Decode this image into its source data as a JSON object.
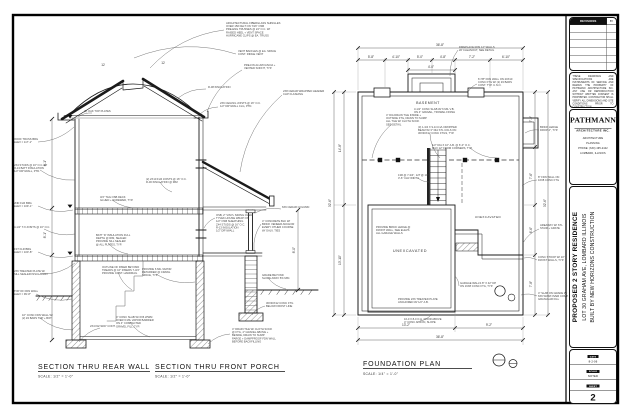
{
  "sheet": {
    "background": "#ffffff",
    "line_color": "#1b1b1b",
    "note_color": "#474747"
  },
  "drawings": [
    {
      "id": "rear-wall",
      "label": "SECTION THRU REAR WALL",
      "scale": "SCALE: 1/2\" = 1'-0\""
    },
    {
      "id": "front-porch",
      "label": "SECTION THRU FRONT PORCH",
      "scale": "SCALE: 1/2\" = 1'-0\""
    },
    {
      "id": "foundation",
      "label": "FOUNDATION PLAN",
      "scale": "SCALE: 1/4\" = 1'-0\""
    }
  ],
  "plan_labels": {
    "basement": "BASEMENT",
    "unexcavated_1": "UNEXCAVATED",
    "unexcavated_2": "UNEXCAVATED"
  },
  "titleblock": {
    "revisions": {
      "header": "REVISIONS",
      "by": "BY"
    },
    "disclaimer": "THESE DRAWINGS AND SPECIFICATIONS ARE INSTRUMENTS OF SERVICE AND REMAIN THE PROPERTY OF PATHMANN ARCHITECTURE INC. ANY USE OR REPRODUCTION WITHOUT WRITTEN CONSENT IS PROHIBITED. CONTRACTOR SHALL VERIFY ALL DIMENSIONS AND SITE CONDITIONS PRIOR TO CONSTRUCTION.",
    "firm": {
      "name": "PATHMANN",
      "sub": "ARCHITECTURE INC.",
      "lines": [
        "ARCHITECTURE",
        "PLANNING",
        "PHONE: (630) 495-2442",
        "LOMBARD, ILLINOIS"
      ]
    },
    "project": {
      "lines": [
        "PROPOSED 2 STORY RESIDENCE",
        "LOT 30 GRAHAM AVE, LOMBARD ILLINOIS",
        "BUILT BY NEW HORIZONS CONSTRUCTION"
      ]
    },
    "sheetinfo": {
      "rows": [
        {
          "label": "DATE",
          "value": "8-2-06"
        },
        {
          "label": "SCALE",
          "value": "NOTED"
        },
        {
          "label": "DRAWN",
          "value": "RP"
        }
      ],
      "sheet_label": "SHEET",
      "number": "2",
      "of_label": "OF",
      "of_value": "FIVE"
    }
  },
  "callouts": [
    {
      "x": 226,
      "y": 24,
      "s": [
        224,
        30
      ],
      "t": [
        150,
        68
      ],
      "l": [
        "ARCHITECTURAL FIBERGLASS SHINGLES",
        "OVER 15# FELT ON 7/16\" OSB",
        "PRE-ENG TRUSSES @ 24\" O.C. W/",
        "RAISED HEEL + VENT SPACE",
        "HURRICANE CLIPS @ EA. TRUSS"
      ]
    },
    {
      "x": 238,
      "y": 52,
      "s": [
        236,
        54
      ],
      "t": [
        134,
        58
      ],
      "l": [
        "VENT BAFFLES @ EA. SPACE",
        "CONT. RIDGE VENT"
      ]
    },
    {
      "x": 244,
      "y": 66,
      "s": [
        242,
        70
      ],
      "t": [
        207,
        112
      ],
      "l": [
        "PRE-FIN ALUM FASCIA +",
        "VENTED SOFFIT, TYP."
      ]
    },
    {
      "x": 208,
      "y": 88,
      "s": [
        206,
        89
      ],
      "t": [
        178,
        98
      ],
      "l": [
        "R-38 INSULATION"
      ]
    },
    {
      "x": 220,
      "y": 104,
      "s": [
        218,
        107
      ],
      "t": [
        200,
        114
      ],
      "l": [
        "2X6 CEILING JOISTS @ 16\" O.C.",
        "1/2\" DRYWALL CLG, PTD."
      ]
    },
    {
      "x": 84,
      "y": 112,
      "t": [
        78,
        117
      ],
      "s": [
        92,
        113
      ],
      "l": [
        "(2) OAK TOP PLATES"
      ]
    },
    {
      "x": 14,
      "y": 140,
      "s": [
        38,
        142
      ],
      "t": [
        74,
        127
      ],
      "l": [
        "ROOF TRUSS BRG",
        "ELEV = 117'-1\""
      ]
    },
    {
      "x": 14,
      "y": 166,
      "s": [
        40,
        170
      ],
      "t": [
        75,
        180
      ],
      "l": [
        "2X4 STUDS @ 16\" O.C. W/",
        "R-13 BATT INSULATION",
        "1/2\" DRYWALL, PTD."
      ]
    },
    {
      "x": 100,
      "y": 198,
      "s": [
        112,
        200
      ],
      "t": [
        140,
        208
      ],
      "l": [
        "3/4\" T&G OSB DECK",
        "GLUED + SCREWED, TYP."
      ]
    },
    {
      "x": 14,
      "y": 204,
      "s": [
        38,
        206
      ],
      "t": [
        73,
        210
      ],
      "l": [
        "2ND FLR BRG",
        "ELEV = 109'-1\""
      ]
    },
    {
      "x": 14,
      "y": 228,
      "s": [
        44,
        229
      ],
      "t": [
        75,
        234
      ],
      "l": [
        "9-1/2\" TJI JOISTS @ 16\" O.C."
      ]
    },
    {
      "x": 14,
      "y": 250,
      "s": [
        38,
        252
      ],
      "t": [
        73,
        256
      ],
      "l": [
        "1ST FLR BRG",
        "ELEV = 100'-8\""
      ]
    },
    {
      "x": 96,
      "y": 236,
      "s": [
        108,
        243
      ],
      "t": [
        128,
        254
      ],
      "l": [
        "BATT 'R' INSULATION FULL",
        "DEPTH @ RIM, SEALED",
        "PROVIDE SILL SEALER",
        "@ ALL PLATES, TYP."
      ]
    },
    {
      "x": 14,
      "y": 272,
      "s": [
        42,
        274
      ],
      "t": [
        75,
        263
      ],
      "l": [
        "2X6 TREATED PLATE W/",
        "SILL SEALER INSULATION"
      ]
    },
    {
      "x": 14,
      "y": 292,
      "s": [
        36,
        294
      ],
      "t": [
        72,
        299
      ],
      "l": [
        "TOP OF FDN WALL",
        "ELEV = 99'-8\""
      ]
    },
    {
      "x": 22,
      "y": 316,
      "s": [
        40,
        318
      ],
      "t": [
        73,
        330
      ],
      "l": [
        "10\" CONC FDN WALL W/",
        "(2) #4 BARS TOP + BOT"
      ]
    },
    {
      "x": 90,
      "y": 327,
      "s": [
        100,
        328
      ],
      "t": [
        79,
        342
      ],
      "l": [
        "2X4 KEYWAY CONT."
      ]
    },
    {
      "x": 116,
      "y": 318,
      "s": [
        130,
        322
      ],
      "t": [
        150,
        337
      ],
      "l": [
        "4\" CONC SLAB W/ 6X6 WWM",
        "OVER 6 MIL VAPOR BARRIER",
        "ON 4\" COMPACTED",
        "GRAVEL FILL, TYP."
      ]
    },
    {
      "x": 102,
      "y": 268,
      "s": [
        118,
        272
      ],
      "t": [
        132,
        290
      ],
      "l": [
        "OUTLINE OF RISER BEYOND",
        "TREADS @ 10\" RISERS 7-3/4\"",
        "PROVIDE CONT. HANDRAIL"
      ]
    },
    {
      "x": 216,
      "y": 216,
      "s": [
        215,
        218
      ],
      "t": [
        204,
        228
      ],
      "l": [
        "OSB, 2\" VINYL SIDING OVER",
        "TYVEK HOUSE WRAP ON",
        "1/2\" OSB SHEATHING",
        "2X4 STUDS @ 16\" O.C.",
        "R-13 INSULATION",
        "1/2\" DRYWALL"
      ]
    },
    {
      "x": 262,
      "y": 222,
      "s": [
        261,
        224
      ],
      "t": [
        254,
        250
      ],
      "l": [
        "4\" CONCRETE BLK W/",
        "BRICK VENEER ANCHOR",
        "EVERY OTHER COURSE",
        "W/ GALV. TIES"
      ]
    },
    {
      "x": 146,
      "y": 180,
      "s": [
        160,
        182
      ],
      "t": [
        172,
        192
      ],
      "l": [
        "(2) 2X10 FLR JOISTS @ 16\" O.C.",
        "R-30 INSULATION @ RIM"
      ]
    },
    {
      "x": 282,
      "y": 208,
      "s": [
        281,
        209
      ],
      "t": [
        255,
        213
      ],
      "l": [
        "6X6 CEDAR COLUMN"
      ]
    },
    {
      "x": 283,
      "y": 92,
      "s": [
        282,
        95
      ],
      "t": [
        240,
        172
      ],
      "l": [
        "2X8 CEDAR WRAPPED HEADER",
        "CLIP FLASHING"
      ]
    },
    {
      "x": 142,
      "y": 270,
      "s": [
        156,
        274
      ],
      "t": [
        195,
        282
      ],
      "l": [
        "PROVIDE 6 MIL VAPOR",
        "RETARDER @ CRAWL",
        "SPACE, TYP."
      ]
    },
    {
      "x": 262,
      "y": 276,
      "s": [
        268,
        278
      ],
      "t": [
        286,
        289
      ],
      "l": [
        "GRADE BEYOND",
        "SLOPE AWAY 5% MIN."
      ]
    },
    {
      "x": 232,
      "y": 330,
      "s": [
        230,
        334
      ],
      "t": [
        208,
        344
      ],
      "l": [
        "4\" DRAIN TILE W/ CLOTH SOCK",
        "@ FTG, 4\" GRAVEL ABOVE +",
        "BESIDE, DRAIN TO SUMP",
        "PARGE + DAMPPROOF FDN WALL",
        "BEFORE BACKFILLING"
      ]
    },
    {
      "x": 266,
      "y": 304,
      "s": [
        265,
        306
      ],
      "t": [
        252,
        315
      ],
      "l": [
        "30X30X12 CONC FTG",
        "BELOW FROST LINE"
      ]
    },
    {
      "x": 478,
      "y": 80,
      "s": [
        477,
        84
      ],
      "t": [
        468,
        92
      ],
      "l": [
        "8 7/8\" FDN WALL ON 20X10",
        "CONC FTG W/ (2) #4 BARS",
        "CONT. TYP. U.N.O."
      ]
    },
    {
      "x": 459,
      "y": 48,
      "s": [
        458,
        50
      ],
      "t": [
        450,
        76
      ],
      "l": [
        "FIREPLACE FDN 12\" WALLS",
        "W/ CLEANOUT, SEE DETAIL"
      ]
    },
    {
      "x": 386,
      "y": 116,
      "s": [
        392,
        124
      ],
      "t": [
        372,
        158
      ],
      "l": [
        "4\" DIA DRAIN TILE INSIDE +",
        "OUTSIDE FTG, DRAIN TO SUMP",
        "ALL TILE W/ CLOTH SOCK",
        "SEE DETAIL"
      ]
    },
    {
      "x": 418,
      "y": 128,
      "s": [
        430,
        134
      ],
      "t": [
        440,
        158
      ],
      "l": [
        "(3) 1-3/4 X 9-1/4 LVL DROPPED",
        "BEAM W/ 3\" DIA STL COLS ON",
        "30X30X12 CONC FTGS, TYP."
      ]
    },
    {
      "x": 432,
      "y": 146,
      "s": [
        470,
        148
      ],
      "t": [
        497,
        158
      ],
      "l": [
        "1/2\" DIA X 10\" A.B. @ 6'-0\" O.C.",
        "MAX 12\" FROM CORNERS, TYP."
      ]
    },
    {
      "x": 540,
      "y": 128,
      "s": [
        539,
        130
      ],
      "t": [
        525,
        133
      ],
      "l": [
        "BRICK LEDGE",
        "DROP 4\", TYP."
      ]
    },
    {
      "x": 538,
      "y": 178,
      "s": [
        537,
        180
      ],
      "t": [
        522,
        186
      ],
      "l": [
        "8\" FDN WALL ON",
        "16X8 CONC FTG"
      ]
    },
    {
      "x": 540,
      "y": 226,
      "s": [
        539,
        229
      ],
      "t": [
        523,
        243
      ],
      "l": [
        "AREAWAY W/ STL",
        "STAIR + GRATE"
      ]
    },
    {
      "x": 538,
      "y": 258,
      "s": [
        537,
        260
      ],
      "t": [
        524,
        258
      ],
      "l": [
        "CONC STOOP W/ 10\"",
        "FROST WALLS, TYP."
      ]
    },
    {
      "x": 538,
      "y": 294,
      "s": [
        537,
        296
      ],
      "t": [
        521,
        295
      ],
      "l": [
        "4\" SLAB ON GRADE W/",
        "6X6 WWM OVER COMP.",
        "GRANULAR FILL"
      ]
    },
    {
      "x": 398,
      "y": 300,
      "l": [
        "PROVIDE 2X6 TREATED PLATE",
        "ANCHORED W/ 1/2\" A.B."
      ]
    },
    {
      "x": 460,
      "y": 284,
      "s": [
        459,
        286
      ],
      "t": [
        455,
        276
      ],
      "l": [
        "GARAGE WALLS 8\" X 42\" DP",
        "ON 16X8 CONC FTG, TYP."
      ]
    },
    {
      "x": 414,
      "y": 110,
      "l": [
        "3-1/2\" CONC SLAB W/ 6 MIL V.B.",
        "ON 4\" GRAVEL, TROWEL FINISH"
      ]
    },
    {
      "x": 398,
      "y": 176,
      "s": [
        418,
        178
      ],
      "t": [
        429,
        182
      ],
      "l": [
        "13R @ 7-3/4\", 12T @ 10\"",
        "3'-6\" CLR WIDTH"
      ]
    },
    {
      "x": 376,
      "y": 228,
      "l": [
        "PROVIDE BRICK LEDGE @",
        "FRONT WALL, SEE ELEVS",
        "ALL GARAGE WALLS"
      ]
    },
    {
      "x": 404,
      "y": 320,
      "s": [
        420,
        321
      ],
      "t": [
        432,
        314
      ],
      "l": [
        "16-0 X 8-0 O.H. DOOR ABOVE",
        "4\" CONC APRON, SLOPE"
      ]
    }
  ],
  "dims": [
    {
      "x": 46,
      "y": 163,
      "l": "8'-1\"",
      "r": -90
    },
    {
      "x": 46,
      "y": 235,
      "l": "8'-1\"",
      "r": -90
    },
    {
      "x": 295,
      "y": 250,
      "l": "8'-0\"",
      "r": -90
    },
    {
      "x": 103,
      "y": 66,
      "l": "12"
    },
    {
      "x": 163,
      "y": 64,
      "l": "12"
    },
    {
      "x": 440,
      "y": 46,
      "l": "36'-8\""
    },
    {
      "x": 371,
      "y": 58,
      "l": "5'-8\""
    },
    {
      "x": 396,
      "y": 58,
      "l": "4'-10\""
    },
    {
      "x": 420,
      "y": 58,
      "l": "5'-0\""
    },
    {
      "x": 443,
      "y": 58,
      "l": "4'-8\""
    },
    {
      "x": 472,
      "y": 58,
      "l": "7'-2\""
    },
    {
      "x": 506,
      "y": 58,
      "l": "6'-10\""
    },
    {
      "x": 431,
      "y": 68,
      "l": "4'-0\""
    },
    {
      "x": 341,
      "y": 148,
      "l": "14'-8\"",
      "r": -90
    },
    {
      "x": 341,
      "y": 260,
      "l": "13'-10\"",
      "r": -90
    },
    {
      "x": 331,
      "y": 203,
      "l": "32'-6\"",
      "r": -90
    },
    {
      "x": 532,
      "y": 119,
      "l": "7'-2\"",
      "r": -90
    },
    {
      "x": 532,
      "y": 176,
      "l": "7'-6\"",
      "r": -90
    },
    {
      "x": 532,
      "y": 230,
      "l": "6'-6\"",
      "r": -90
    },
    {
      "x": 532,
      "y": 284,
      "l": "7'-8\"",
      "r": -90
    },
    {
      "x": 546,
      "y": 203,
      "l": "32'-6\"",
      "r": -90
    },
    {
      "x": 406,
      "y": 326,
      "l": "13'-2\""
    },
    {
      "x": 489,
      "y": 326,
      "l": "9'-2\""
    },
    {
      "x": 440,
      "y": 338,
      "l": "36'-8\""
    }
  ]
}
